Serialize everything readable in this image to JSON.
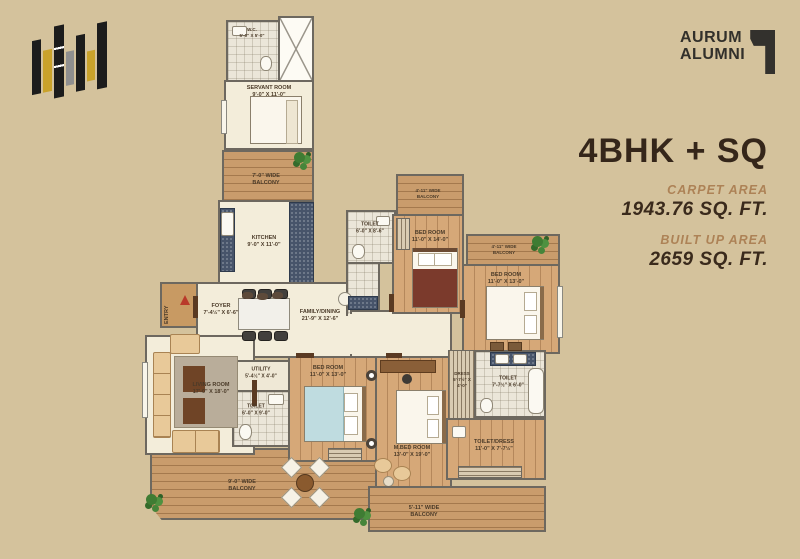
{
  "colors": {
    "background": "#d4c29c",
    "gold": "#c9a22b",
    "text_dark": "#35261a",
    "text_bronze": "#ad8256"
  },
  "brand": {
    "line1": "AURUM",
    "line2": "ALUMNI"
  },
  "unit": {
    "title": "4BHK + SQ",
    "carpet_label": "CARPET AREA",
    "carpet_value": "1943.76 SQ. FT.",
    "builtup_label": "BUILT UP AREA",
    "builtup_value": "2659 SQ. FT."
  },
  "plan": {
    "rooms": {
      "wc": {
        "name": "W.C.",
        "dims": "5'-0\" X 5'-0\""
      },
      "servant": {
        "name": "SERVANT ROOM",
        "dims": "9'-0\" X 11'-0\""
      },
      "balcony_top": {
        "name": "7'-0\" WIDE BALCONY"
      },
      "kitchen": {
        "name": "KITCHEN",
        "dims": "9'-0\" X 11'-0\""
      },
      "entry": {
        "name": "ENTRY"
      },
      "foyer": {
        "name": "FOYER",
        "dims": "7'-4½\" X 6'-6\""
      },
      "family_dining": {
        "name": "FAMILY/DINING",
        "dims": "21'-9\" X 12'-6\""
      },
      "living": {
        "name": "LIVING ROOM",
        "dims": "17'-0\" X 18'-0\""
      },
      "utility": {
        "name": "UTILITY",
        "dims": "5'-4½\" X 4'-0\""
      },
      "toilet_common": {
        "name": "TOILET",
        "dims": "6'-0\" X 9'-0\""
      },
      "bedroom_center": {
        "name": "BED ROOM",
        "dims": "11'-0\" X 13'-0\""
      },
      "master_bedroom": {
        "name": "M.BED ROOM",
        "dims": "13'-0\" X 19'-0\""
      },
      "dress_master": {
        "name": "DRESS",
        "dims": "5'-7½\" X 4'-0\""
      },
      "toilet_master": {
        "name": "TOILET",
        "dims": "7'-7½\" X 6'-0\""
      },
      "toilet_dress": {
        "name": "TOILET/DRESS",
        "dims": "11'-0\" X 7'-7½\""
      },
      "toilet_top": {
        "name": "TOILET",
        "dims": "6'-0\" X 8'-6\""
      },
      "bedroom_top": {
        "name": "BED ROOM",
        "dims": "11'-0\" X 14'-0\""
      },
      "balcony_bed_top": {
        "name": "4'-11\" WIDE BALCONY"
      },
      "bedroom_right": {
        "name": "BED ROOM",
        "dims": "11'-0\" X 13'-0\""
      },
      "balcony_bed_right": {
        "name": "4'-11\" WIDE BALCONY"
      },
      "balcony_bottom": {
        "name": "9'-0\" WIDE BALCONY"
      },
      "balcony_bottom_right": {
        "name": "5'-11\" WIDE BALCONY"
      }
    }
  }
}
